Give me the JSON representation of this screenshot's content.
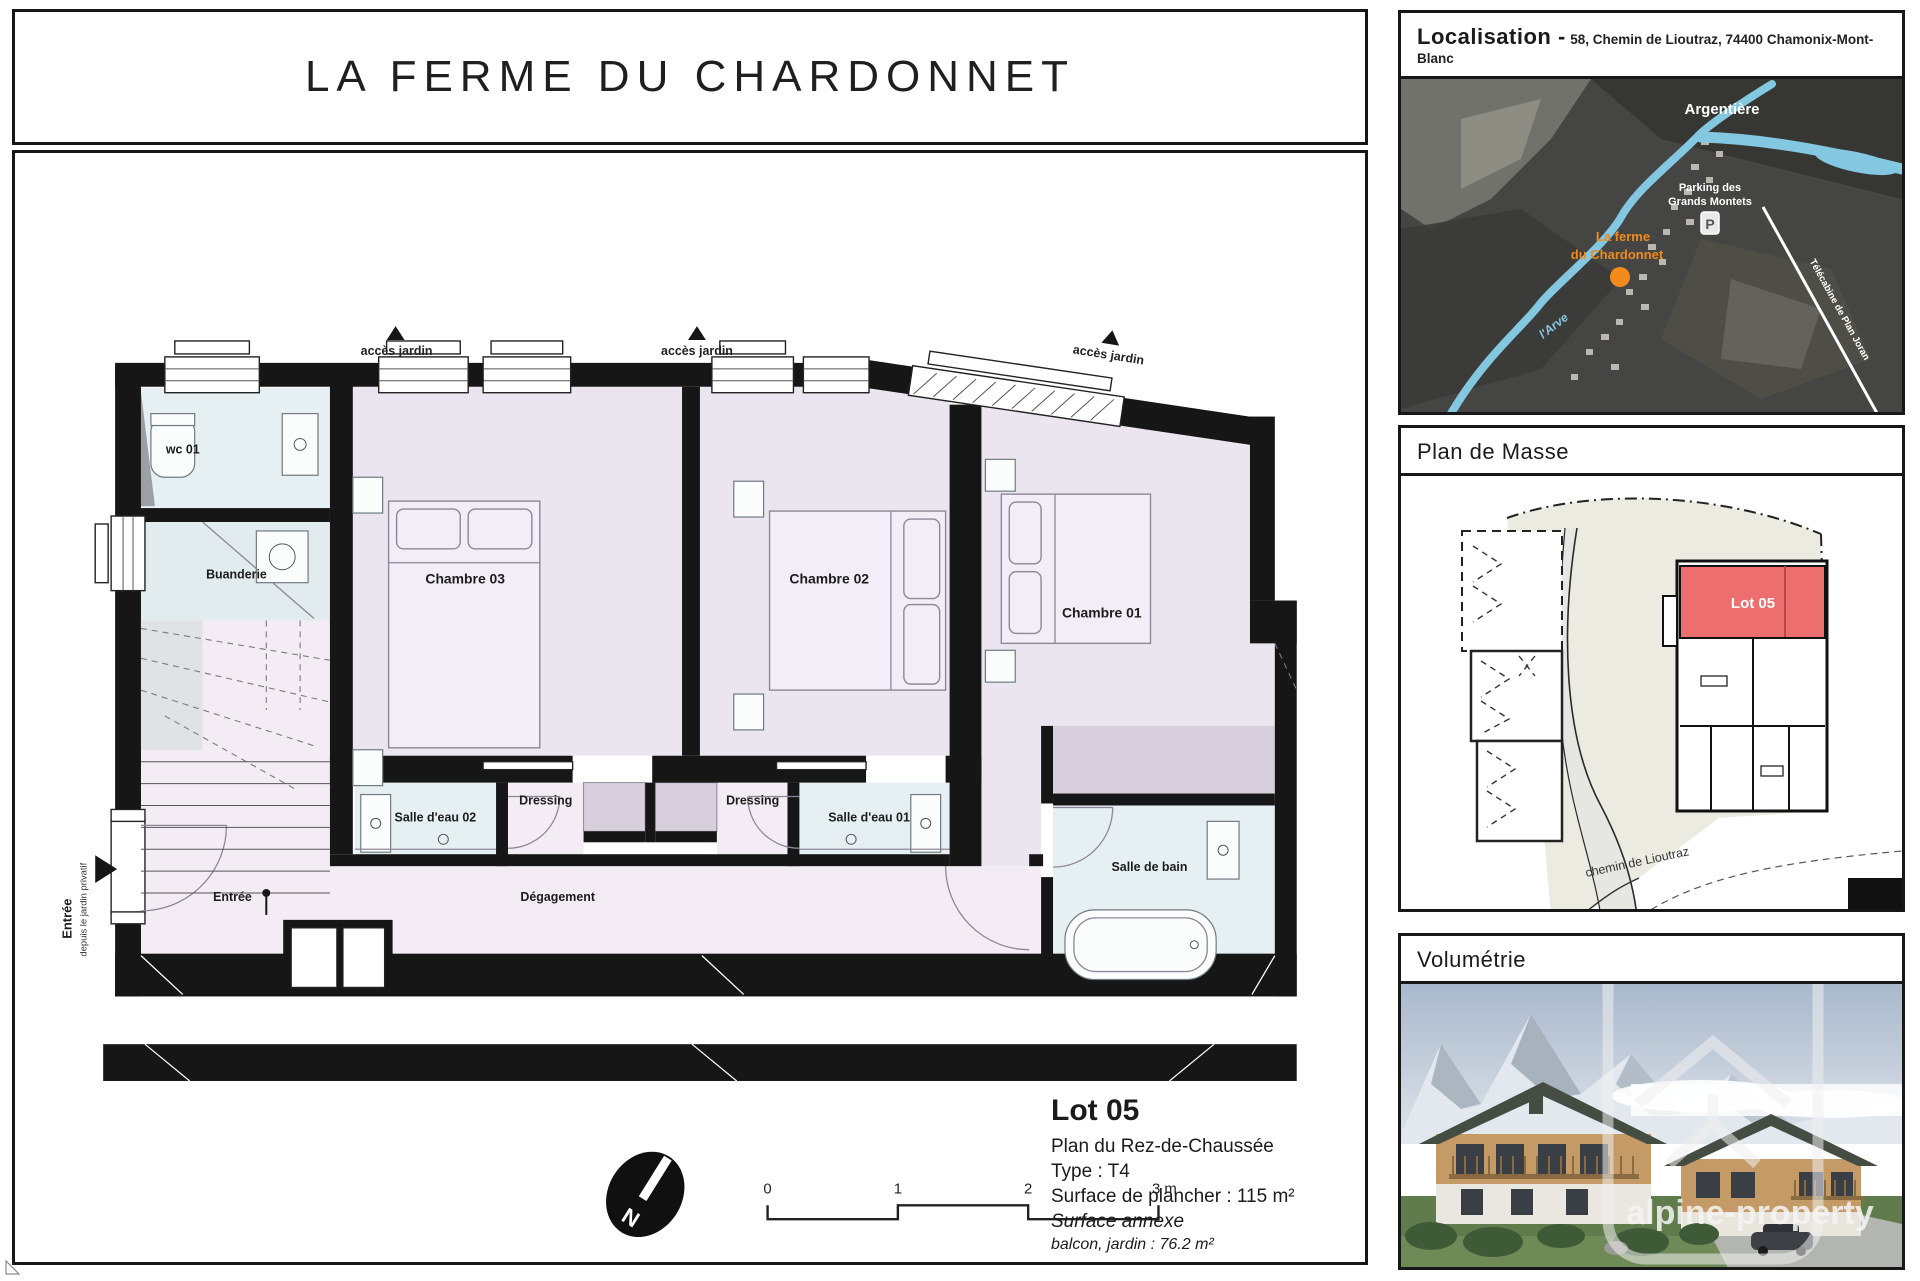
{
  "page": {
    "title": "LA FERME DU CHARDONNET"
  },
  "plan": {
    "access_garden": "accès jardin",
    "entry_arrow": {
      "label": "Entrée",
      "sublabel": "depuis le jardin privatif"
    },
    "rooms": {
      "wc": "wc 01",
      "buanderie": "Buanderie",
      "chambre03": "Chambre 03",
      "chambre02": "Chambre 02",
      "chambre01": "Chambre 01",
      "salle_eau_02": "Salle d'eau 02",
      "salle_eau_01": "Salle d'eau 01",
      "dressing_left": "Dressing",
      "dressing_right": "Dressing",
      "salle_de_bain": "Salle de bain",
      "entree": "Entrée",
      "degagement": "Dégagement"
    },
    "scale": {
      "t0": "0",
      "t1": "1",
      "t2": "2",
      "t3": "3 m"
    },
    "compass_n": "N"
  },
  "lot": {
    "name": "Lot 05",
    "floor": "Plan du Rez-de-Chaussée",
    "type": "Type : T4",
    "surface": "Surface de plancher : 115 m²",
    "annexe_title": "Surface annexe",
    "annexe_detail": "balcon, jardin : 76.2 m²"
  },
  "sidebar": {
    "localisation": {
      "title": "Localisation -",
      "address": "58, Chemin de Lioutraz, 74400 Chamonix-Mont-Blanc",
      "map": {
        "town": "Argentière",
        "parking_line1": "Parking des",
        "parking_line2": "Grands Montets",
        "parking_icon": "P",
        "property_line1": "La ferme",
        "property_line2": "du Chardonnet",
        "river": "l'Arve",
        "lift": "Télécabine de Plan Joran"
      }
    },
    "plan_masse": {
      "title": "Plan de Masse",
      "lot_label": "Lot 05",
      "street": "chemin de Lioutraz"
    },
    "volumetrie": {
      "title": "Volumétrie",
      "watermark": "alpine-property"
    }
  },
  "colors": {
    "wall": "#161616",
    "bedroom": "#ebe5ef",
    "corridor": "#f3ecf4",
    "bathroom": "#e6eff2",
    "wardrobe": "#d7cfdc",
    "lot_red": "#ed6e6e",
    "accent_orange": "#f28a1c",
    "river_blue": "#84c7e0",
    "site_beige": "#ecebe1"
  }
}
